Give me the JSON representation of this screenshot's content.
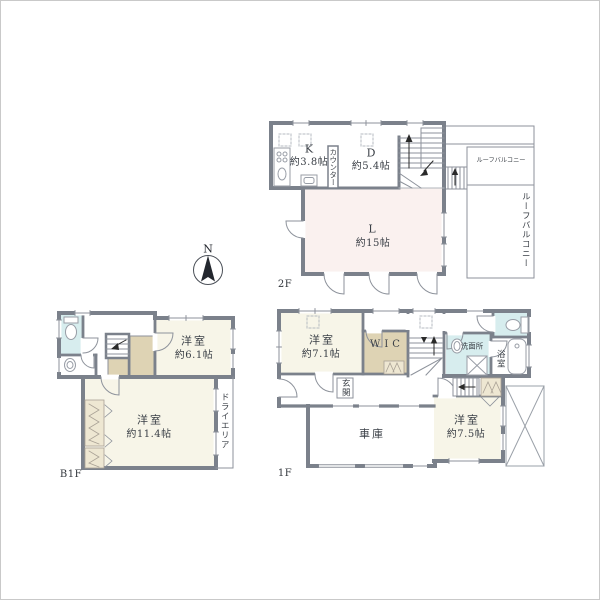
{
  "compass": {
    "north": "N"
  },
  "floors": {
    "f2": {
      "label": "2F",
      "kitchen": {
        "name": "K",
        "size": "約3.8帖"
      },
      "counter": {
        "label": "カウンター"
      },
      "dining": {
        "name": "D",
        "size": "約5.4帖"
      },
      "living": {
        "name": "L",
        "size": "約15帖"
      },
      "roof_balcony_top": {
        "label": "ルーフバルコニー"
      },
      "roof_balcony_side": {
        "label": "ルーフバルコニー"
      }
    },
    "f1": {
      "label": "1F",
      "bedroom_71": {
        "name": "洋室",
        "size": "約7.1帖"
      },
      "wic": {
        "label": "WIC"
      },
      "entrance": {
        "label": "玄関"
      },
      "washroom": {
        "label": "洗面所"
      },
      "bathroom": {
        "label": "浴室"
      },
      "garage": {
        "label": "車庫"
      },
      "bedroom_75": {
        "name": "洋室",
        "size": "約7.5帖"
      }
    },
    "b1f": {
      "label": "B1F",
      "bedroom_61": {
        "name": "洋室",
        "size": "約6.1帖"
      },
      "bedroom_114": {
        "name": "洋室",
        "size": "約11.4帖"
      },
      "dry_area": {
        "label": "ドライエリア"
      }
    }
  },
  "colors": {
    "wall": "#7b818b",
    "thin_line": "#8d929b",
    "room_cream": "#f7f5e8",
    "living_pink": "#faf1ef",
    "closet_beige": "#ded3b4",
    "closet_hatch": "#eee7d2",
    "wet_area_cyan": "#d7edee",
    "text": "#3a3f46"
  }
}
